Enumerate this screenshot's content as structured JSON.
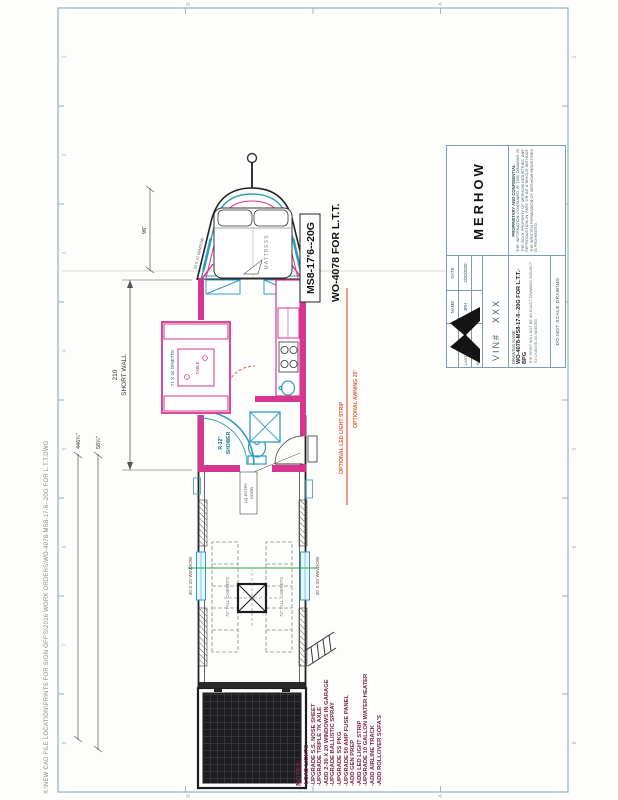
{
  "page": {
    "file_path": "X:\\NEW CAD FILE LOCATION\\PRINTS FOR SIGN OFF'S\\2016 WORK ORDERS\\WO-4078-MS8-17-6--20G FOR L.T.T.DWG"
  },
  "callouts": {
    "model": "MS8-17'6--20G",
    "work_order": "WO-4078 FOR L.T.T.",
    "awning": "OPTIONAL AWNING 20'",
    "led_strip": "OPTIONAL LED LIGHT STRIP"
  },
  "dimensions": {
    "short_wall_value": "210",
    "short_wall_label": "SHORT WALL",
    "overall_length": "446¾\"",
    "rear_section": "56¼\"",
    "nose_length": "96\""
  },
  "labels": {
    "mattress": "MATTRESS",
    "dinette": "71 X 34 DINETTE",
    "table": "TABLE",
    "shower_size": "R-32\"",
    "shower": "SHOWER",
    "garage_window": "30 X 20 WINDOW",
    "cabinets": "72\" TALL CABINETS",
    "nose_window": "34 X 22 WINDOW",
    "entry_door_line1": "LQ ENTRY",
    "entry_door_line2": "DOOR"
  },
  "notes": {
    "title": "NOTES:",
    "items": [
      "-LOAD LIGHTS",
      "-UPGRADE S.S. NOSE SHEET",
      "-UPGRADE TRIPLE 7K AXLE",
      "-ADD 2-30 X 20 WINDOWS IN GARAGE",
      "-UPGRADE BALLISTIC SPRAY",
      "-UPGRADE SS PKG",
      "-UPGRADE 50 AMP FUSE PANEL",
      "-ADD GEN PREP",
      "-ADD LED LIGHT STRIP",
      "-UPGRADE 10 GALLON WATER HEATER",
      "-ADD AIRLINE TRACK",
      "-ADD ROLLOVER SOFA'S"
    ]
  },
  "title_block": {
    "brand": "MERHOW",
    "proprietary_title": "PROPRIETARY AND CONFIDENTIAL",
    "proprietary_text": "THE INFORMATION CONTAINED IN THIS DRAWING IS THE SOLE PROPERTY OF MERHOW INDUSTRIES. ANY REPRODUCTION IN PART OR AS A WHOLE WITHOUT THE WRITTEN PERMISSION OF MERHOW INDUSTRIES IS PROHIBITED.",
    "name_header": "NAME",
    "date_header": "DATE",
    "saved_by_label": "LAST SAVED BY:",
    "saved_by_name": "JRH",
    "saved_by_date": "2/20/2020",
    "qa_label": "Q.A.",
    "vin_label": "VIN#",
    "vin_value": "XXX",
    "drawing_name_label": "DRAWING NAME:",
    "drawing_name": "WO-4078-MS8-17-6--20G FOR L.T.T.-BPG",
    "drawing_note": "THE PRINT WILL NOT BE AN EXACT DRAWING SUBJECT TO CHANGE AS NEEDED",
    "no_scale": "DO NOT SCALE DRAWING"
  },
  "zones": {
    "numbers": [
      "8",
      "7",
      "6",
      "5",
      "4",
      "3",
      "2",
      "1"
    ],
    "letters": [
      "B",
      "A"
    ]
  },
  "colors": {
    "wall_pink": "#d6368f",
    "fixture_blue": "#2f9dc4",
    "annotation_orange": "#e0623c",
    "border_blue": "#8fb3c6",
    "notes_maroon": "#7a2545",
    "green_line": "#2f9e44"
  }
}
